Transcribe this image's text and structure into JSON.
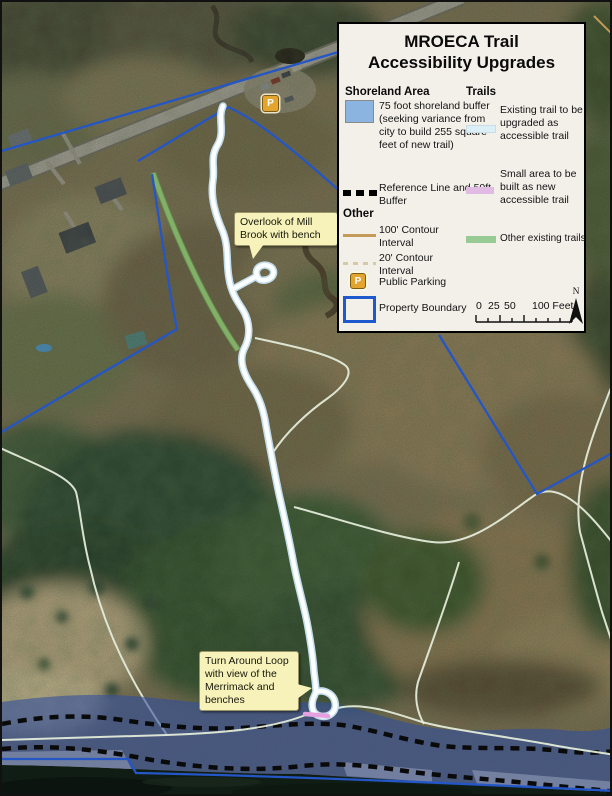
{
  "legend": {
    "title1": "MROECA Trail",
    "title2": "Accessibility Upgrades",
    "shoreland": {
      "header": "Shoreland Area",
      "buffer_label": "75 foot shoreland buffer (seeking variance from city to build 255 square feet of new trail)",
      "reference_label": "Reference Line and 50ft Buffer"
    },
    "other": {
      "header": "Other",
      "contour100": "100' Contour Interval",
      "contour20": "20' Contour Interval",
      "parking": "Public Parking",
      "property": "Property Boundary"
    },
    "trails": {
      "header": "Trails",
      "existing": "Existing trail to be upgraded as accessible trail",
      "new_small": "Small area to be built as new accessible trail",
      "other_existing": "Other existing trails"
    },
    "scale": {
      "t0": "0",
      "t25": "25",
      "t50": "50",
      "t100": "100 Feet"
    },
    "north": "N"
  },
  "symbols": {
    "parking": "P"
  },
  "callouts": [
    {
      "text": "Overlook of Mill Brook with bench"
    },
    {
      "text": "Turn Around Loop with view of the Merrimack and benches"
    }
  ],
  "colors": {
    "shoreland_buffer": "#8CB4E0",
    "shoreland_overlay": "rgba(47,77,160,0.58)",
    "existing_trail": "#DCEEF6",
    "new_accessible_trail": "#E0BBE4",
    "other_trails": "#97CB93",
    "property_boundary": "#1E5ACD",
    "contour_100": "#C49A5A",
    "contour_20": "#D6C9A6",
    "parking_badge": "#E3A52F",
    "callout_bg": "#F6F2B9",
    "reference_line": "#000000"
  }
}
